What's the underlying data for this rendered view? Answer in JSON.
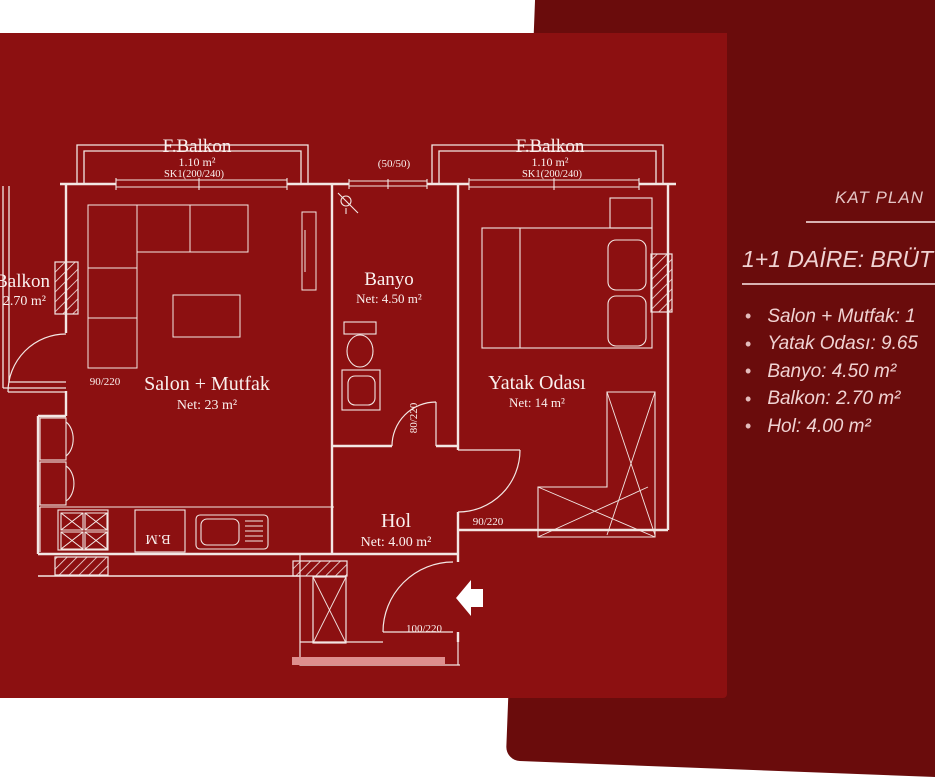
{
  "colors": {
    "page": "#ffffff",
    "plan_panel": "#8c1011",
    "dark_band": "#6a0c0c",
    "plan_lines": "#f3e7e4",
    "accent_bar": "#de8e8e",
    "panel_text": "#f0d2d2"
  },
  "side_panel": {
    "heading": "KAT PLAN",
    "subheading": "1+1 DAİRE: BRÜT",
    "bullets": [
      "Salon + Mutfak: 1",
      "Yatak Odası: 9.65",
      "Banyo: 4.50 m²",
      "Balkon: 2.70 m²",
      "Hol: 4.00 m²"
    ]
  },
  "plan": {
    "rooms": {
      "fbalkon_left": {
        "name": "F.Balkon",
        "area": "1.10 m²",
        "window": "SK1(200/240)"
      },
      "fbalkon_right": {
        "name": "F.Balkon",
        "area": "1.10 m²",
        "window": "SK1(200/240)"
      },
      "salon": {
        "name": "Salon + Mutfak",
        "area": "Net: 23 m²"
      },
      "yatak": {
        "name": "Yatak Odası",
        "area": "Net: 14 m²"
      },
      "banyo": {
        "name": "Banyo",
        "area": "Net: 4.50 m²"
      },
      "hol": {
        "name": "Hol",
        "area": "Net: 4.00 m²"
      },
      "balkon_left": {
        "name": "Balkon",
        "area": "2.70 m²"
      }
    },
    "dims": {
      "window_5050": "(50/50)",
      "door_balkon": "90/220",
      "door_banyo": "80/220",
      "door_yatak": "90/220",
      "door_entry": "100/220",
      "appliance_bm": "B.M"
    }
  }
}
